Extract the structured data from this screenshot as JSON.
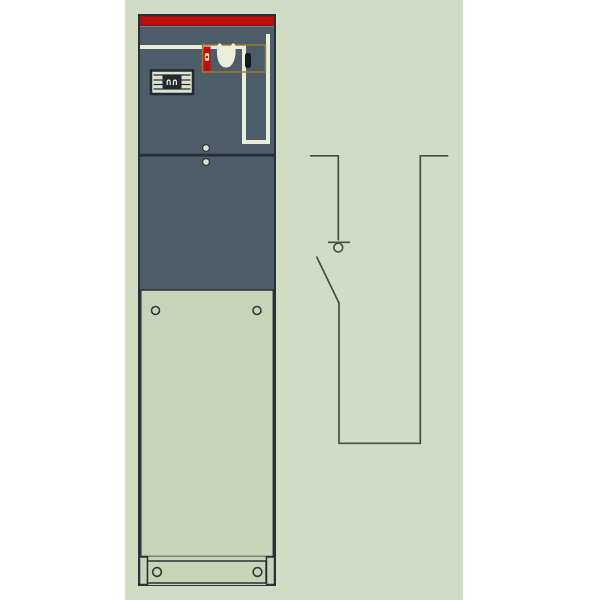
{
  "colors": {
    "page-bg": "#ffffff",
    "canvas-bg": "#d2dcc5",
    "outline": "#2a3138",
    "accent-red": "#c20d0d",
    "panel-dark": "#4d5c69",
    "door-light": "#c9d3b8",
    "mimic-white": "#e9edd9",
    "mimic-orange": "#a67a24",
    "display-dark": "#232930",
    "display-light": "#dde3cc",
    "slot-black": "#15181c",
    "flag-mark": "#e9dcae",
    "divider": "#272e35",
    "screw-fill": "#dfe3cf",
    "screw-ring": "#2f363c",
    "schematic-line": "#44503f"
  },
  "indicator_display": {
    "reading": "∩∩"
  }
}
